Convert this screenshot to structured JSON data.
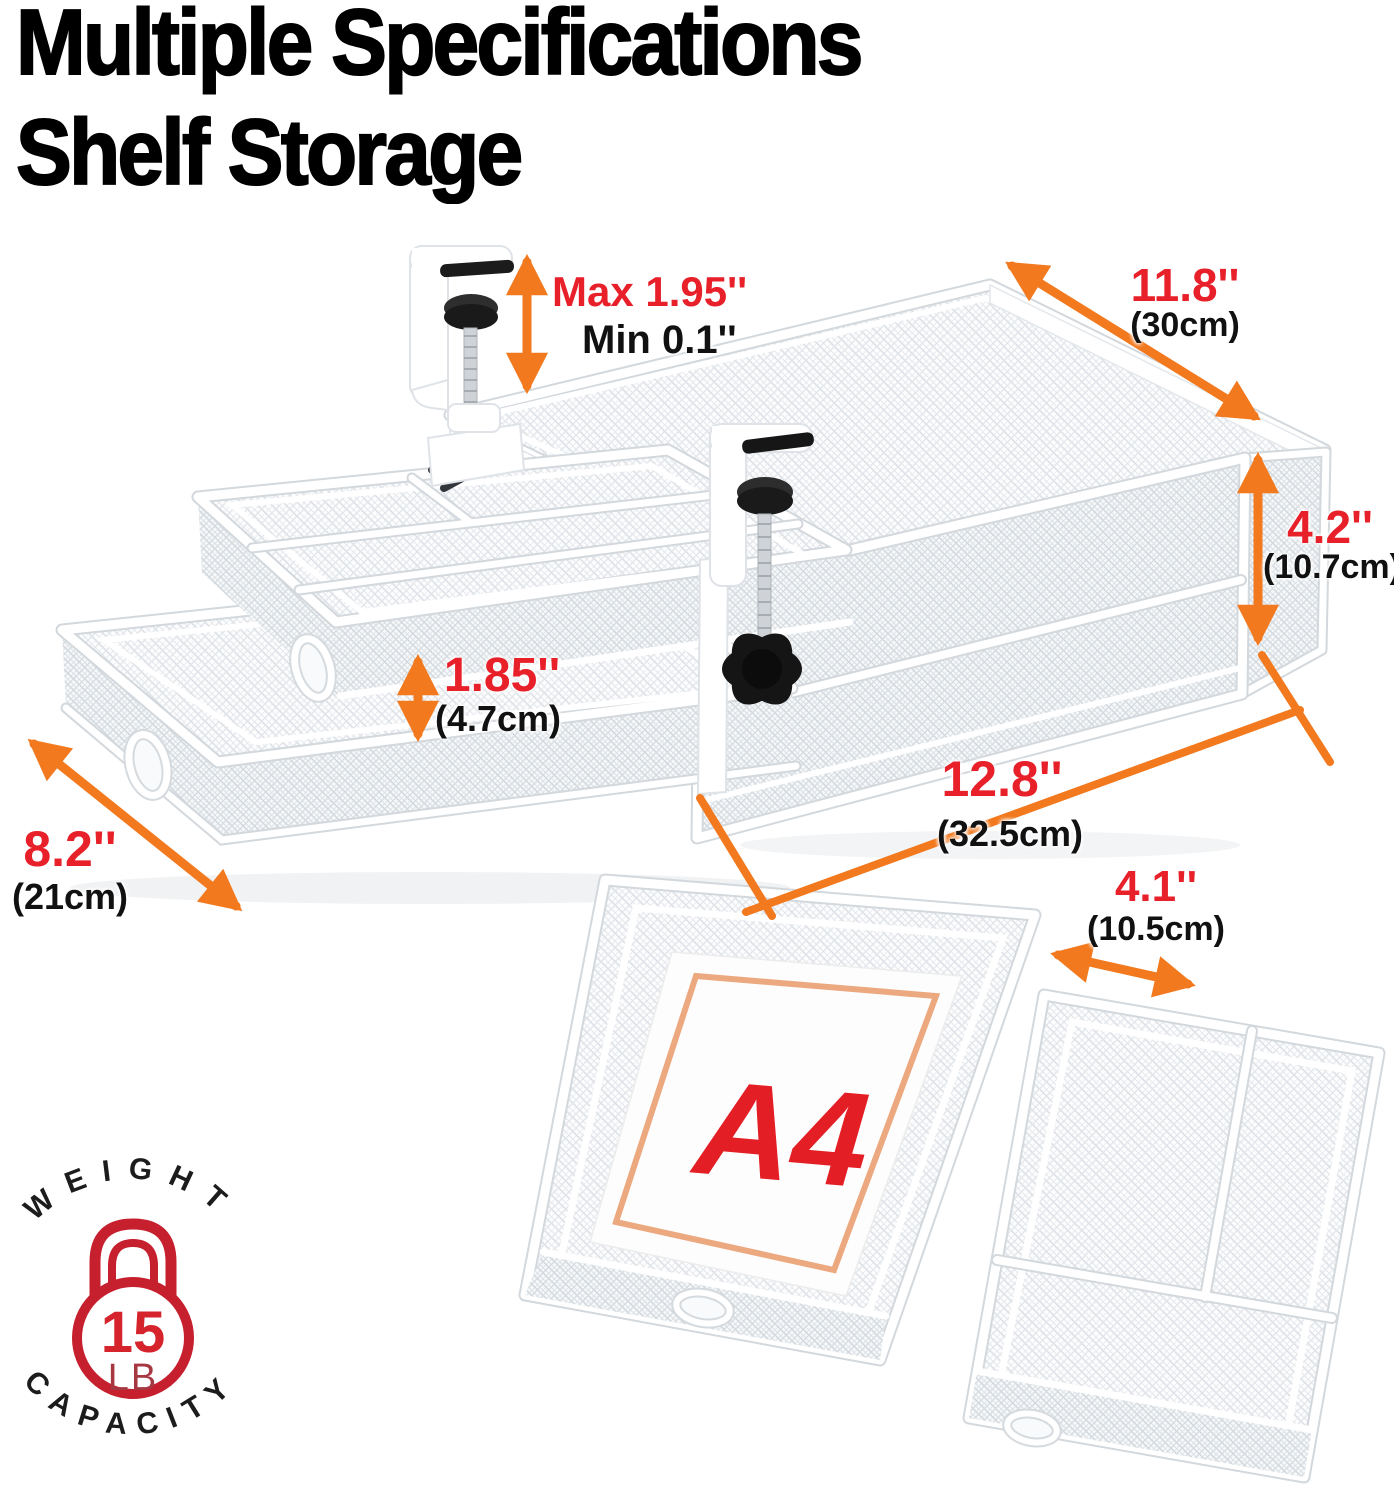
{
  "title": {
    "line1": "Multiple Specifications",
    "line2": "Shelf Storage"
  },
  "dimensions": {
    "clamp_opening": {
      "max": "Max 1.95''",
      "min": "Min 0.1''"
    },
    "shelf_depth": {
      "inches": "11.8''",
      "metric": "(30cm)"
    },
    "box_height": {
      "inches": "4.2''",
      "metric": "(10.7cm)"
    },
    "organizer_height": {
      "inches": "1.85''",
      "metric": "(4.7cm)"
    },
    "shelf_width": {
      "inches": "12.8''",
      "metric": "(32.5cm)"
    },
    "drawer_depth": {
      "inches": "8.2''",
      "metric": "(21cm)"
    },
    "compartment_width": {
      "inches": "4.1''",
      "metric": "(10.5cm)"
    }
  },
  "paper_label": "A4",
  "badge": {
    "top_text": "WEIGHT",
    "bottom_text": "CAPACITY",
    "value": "15",
    "unit": "LB"
  },
  "colors": {
    "arrow_orange": "#F2791E",
    "label_red": "#E8202A",
    "badge_red": "#C6202E",
    "a4_border": "#ECA87E",
    "text_black": "#111111"
  }
}
